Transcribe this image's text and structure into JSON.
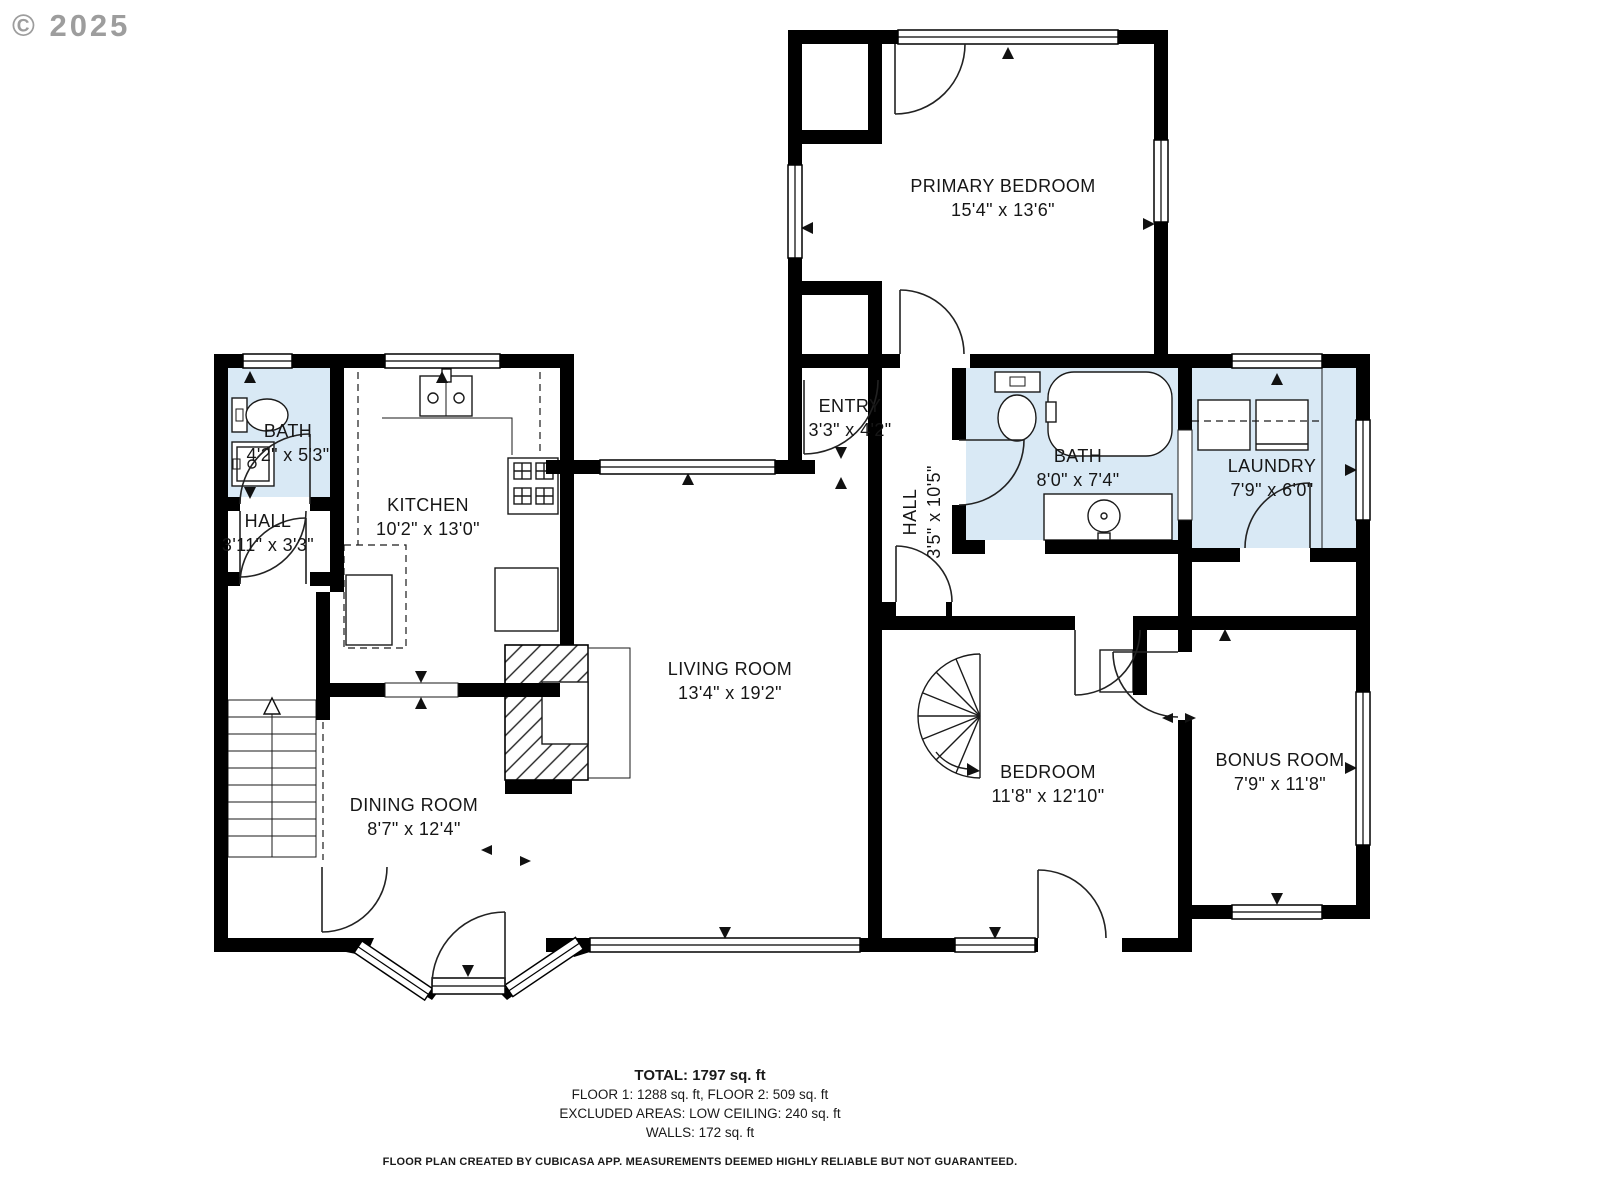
{
  "watermark": "© 2025",
  "colors": {
    "wall": "#000000",
    "wet_room": "#d9e9f5",
    "line": "#1a1a1a",
    "watermark": "#8c8c8c",
    "background": "#ffffff"
  },
  "rooms": {
    "primary_bedroom": {
      "name": "PRIMARY BEDROOM",
      "dims": "15'4\" x 13'6\""
    },
    "entry": {
      "name": "ENTRY",
      "dims": "3'3\" x 4'2\""
    },
    "hall_upper": {
      "name": "HALL",
      "dims": "3'5\" x 10'5\""
    },
    "bath_main": {
      "name": "BATH",
      "dims": "8'0\" x 7'4\""
    },
    "laundry": {
      "name": "LAUNDRY",
      "dims": "7'9\" x 6'0\""
    },
    "bath_small": {
      "name": "BATH",
      "dims": "4'2\" x 5'3\""
    },
    "hall_small": {
      "name": "HALL",
      "dims": "3'11\" x 3'3\""
    },
    "kitchen": {
      "name": "KITCHEN",
      "dims": "10'2\" x 13'0\""
    },
    "living_room": {
      "name": "LIVING ROOM",
      "dims": "13'4\" x 19'2\""
    },
    "dining_room": {
      "name": "DINING ROOM",
      "dims": "8'7\" x 12'4\""
    },
    "bedroom": {
      "name": "BEDROOM",
      "dims": "11'8\" x 12'10\""
    },
    "bonus_room": {
      "name": "BONUS ROOM",
      "dims": "7'9\" x 11'8\""
    }
  },
  "summary": {
    "total": "TOTAL: 1797 sq. ft",
    "floors": "FLOOR 1: 1288 sq. ft, FLOOR 2: 509 sq. ft",
    "excluded": "EXCLUDED AREAS: LOW CEILING: 240 sq. ft",
    "walls": "WALLS: 172 sq. ft"
  },
  "disclaimer": "FLOOR PLAN CREATED BY CUBICASA APP. MEASUREMENTS DEEMED HIGHLY RELIABLE BUT NOT GUARANTEED."
}
